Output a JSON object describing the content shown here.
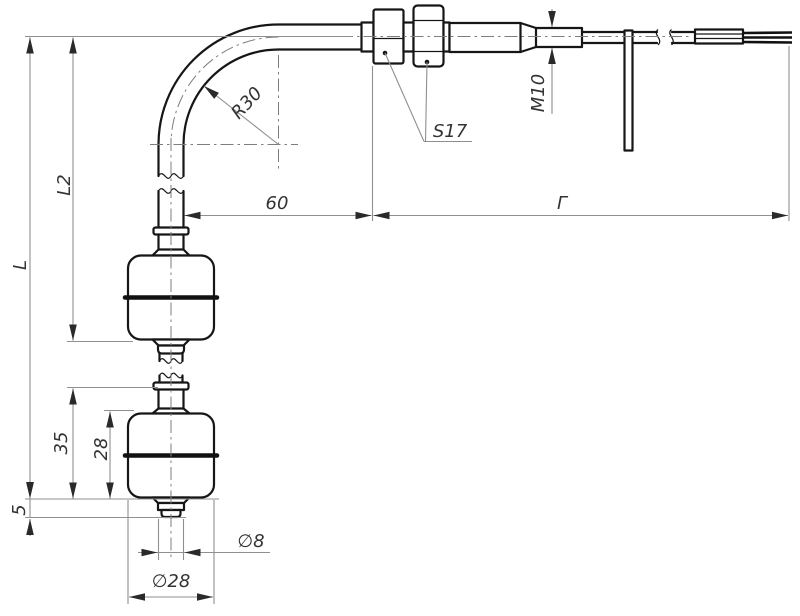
{
  "drawing": {
    "background": "#ffffff",
    "outline_color": "#161616",
    "dimension_color": "#8f8f8f",
    "text_color": "#333333",
    "labels": {
      "total_length": "L",
      "upper_float_level": "L2",
      "lower_float_span": "35",
      "float_height": "28",
      "end_offset": "5",
      "bend_radius": "R30",
      "bend_offset": "60",
      "cable_length": "Г",
      "wrench_size": "S17",
      "thread": "M10",
      "tube_diameter": "∅8",
      "float_diameter": "∅28"
    }
  }
}
